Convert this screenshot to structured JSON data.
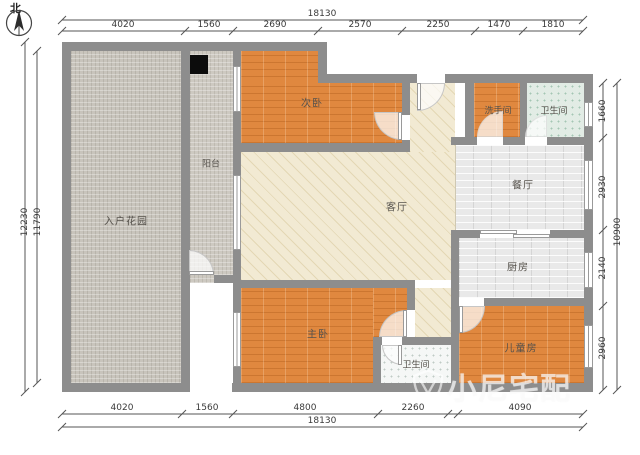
{
  "compass": {
    "label": "北"
  },
  "watermark": {
    "text": "小尼宅配",
    "logo": "shield-logo-icon"
  },
  "rooms": {
    "entry_garden": {
      "label": "入户花园"
    },
    "balcony": {
      "label": "阳台"
    },
    "second_bedroom": {
      "label": "次卧"
    },
    "washroom": {
      "label": "洗手间"
    },
    "bathroom_top": {
      "label": "卫生间"
    },
    "dining": {
      "label": "餐厅"
    },
    "living": {
      "label": "客厅"
    },
    "kitchen": {
      "label": "厨房"
    },
    "master_bedroom": {
      "label": "主卧"
    },
    "bathroom_bottom": {
      "label": "卫生间"
    },
    "kids_room": {
      "label": "儿童房"
    }
  },
  "dimensions": {
    "top": {
      "total": "18130",
      "segments": [
        "4020",
        "1560",
        "2690",
        "2570",
        "2250",
        "1470",
        "1810"
      ]
    },
    "bottom": {
      "total": "18130",
      "segments": [
        "4020",
        "1560",
        "4800",
        "2260",
        "4090"
      ]
    },
    "left": {
      "outer": "12230",
      "inner": "11790"
    },
    "right": {
      "total": "10900",
      "segments": [
        "1660",
        "2930",
        "2140",
        "2960"
      ]
    }
  },
  "colors": {
    "wall": "#8d8d8d",
    "wood_floor": "#e0883f",
    "tile_floor": "#e9e9e9",
    "living_floor": "#f2ead3",
    "garden_floor": "#c8c4bc",
    "bath_floor": "#e2ece5"
  }
}
